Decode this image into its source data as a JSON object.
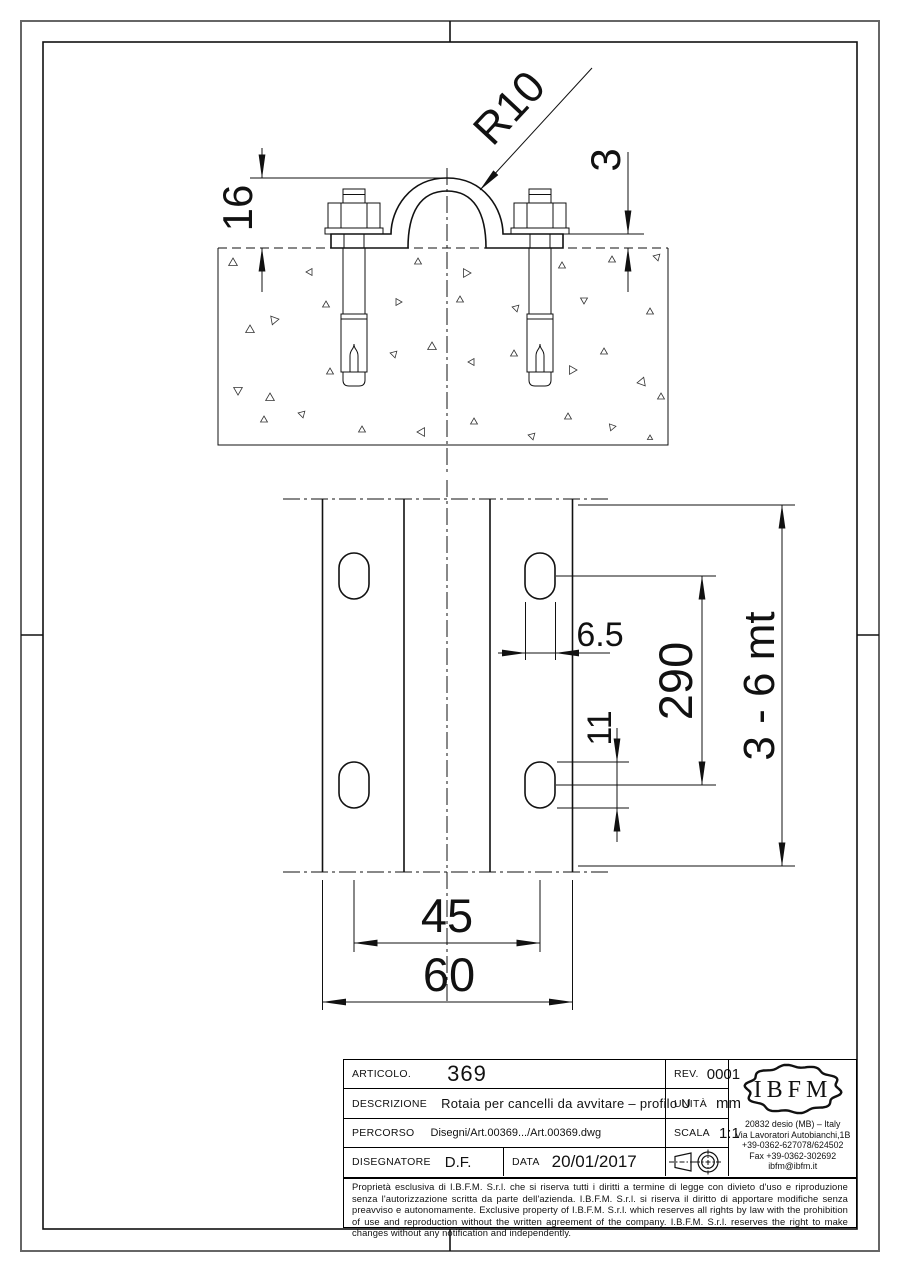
{
  "drawing": {
    "dimensions": {
      "radius": "R10",
      "profile_height": "16",
      "thickness": "3",
      "slot_width": "6.5",
      "hole_pitch": "290",
      "slot_length": "11",
      "rail_length": "3 - 6 mt",
      "hole_spacing": "45",
      "rail_width": "60"
    }
  },
  "title_block": {
    "articolo": {
      "label": "ARTICOLO.",
      "value": "369"
    },
    "rev": {
      "label": "REV.",
      "value": "0001"
    },
    "descrizione": {
      "label": "DESCRIZIONE",
      "value": "Rotaia per cancelli da avvitare – profilo U"
    },
    "unita": {
      "label": "UNITÀ",
      "value": "mm"
    },
    "percorso": {
      "label": "PERCORSO",
      "value": "Disegni/Art.00369.../Art.00369.dwg"
    },
    "scala": {
      "label": "SCALA",
      "value": "1:1"
    },
    "disegnatore": {
      "label": "DISEGNATORE",
      "value": "D.F."
    },
    "data": {
      "label": "DATA",
      "value": "20/01/2017"
    },
    "company": {
      "logo": "IBFM",
      "address_lines": [
        "20832 desio (MB) – Italy",
        "Via Lavoratori Autobianchi,1B",
        "+39-0362-627078/624502",
        "Fax +39-0362-302692",
        "ibfm@ibfm.it"
      ]
    },
    "legal": "Proprietà esclusiva di I.B.F.M. S.r.l. che si riserva tutti i diritti a termine di legge con divieto d'uso e riproduzione senza l'autorizzazione scritta da parte dell'azienda. I.B.F.M. S.r.l. si riserva il diritto di apportare modifiche senza preavviso e autonomamente. Exclusive property of I.B.F.M. S.r.l. which reserves all rights by law with the prohibition of use and reproduction without the written agreement of the company. I.B.F.M. S.r.l. reserves the right to make changes without any notification and independently."
  }
}
